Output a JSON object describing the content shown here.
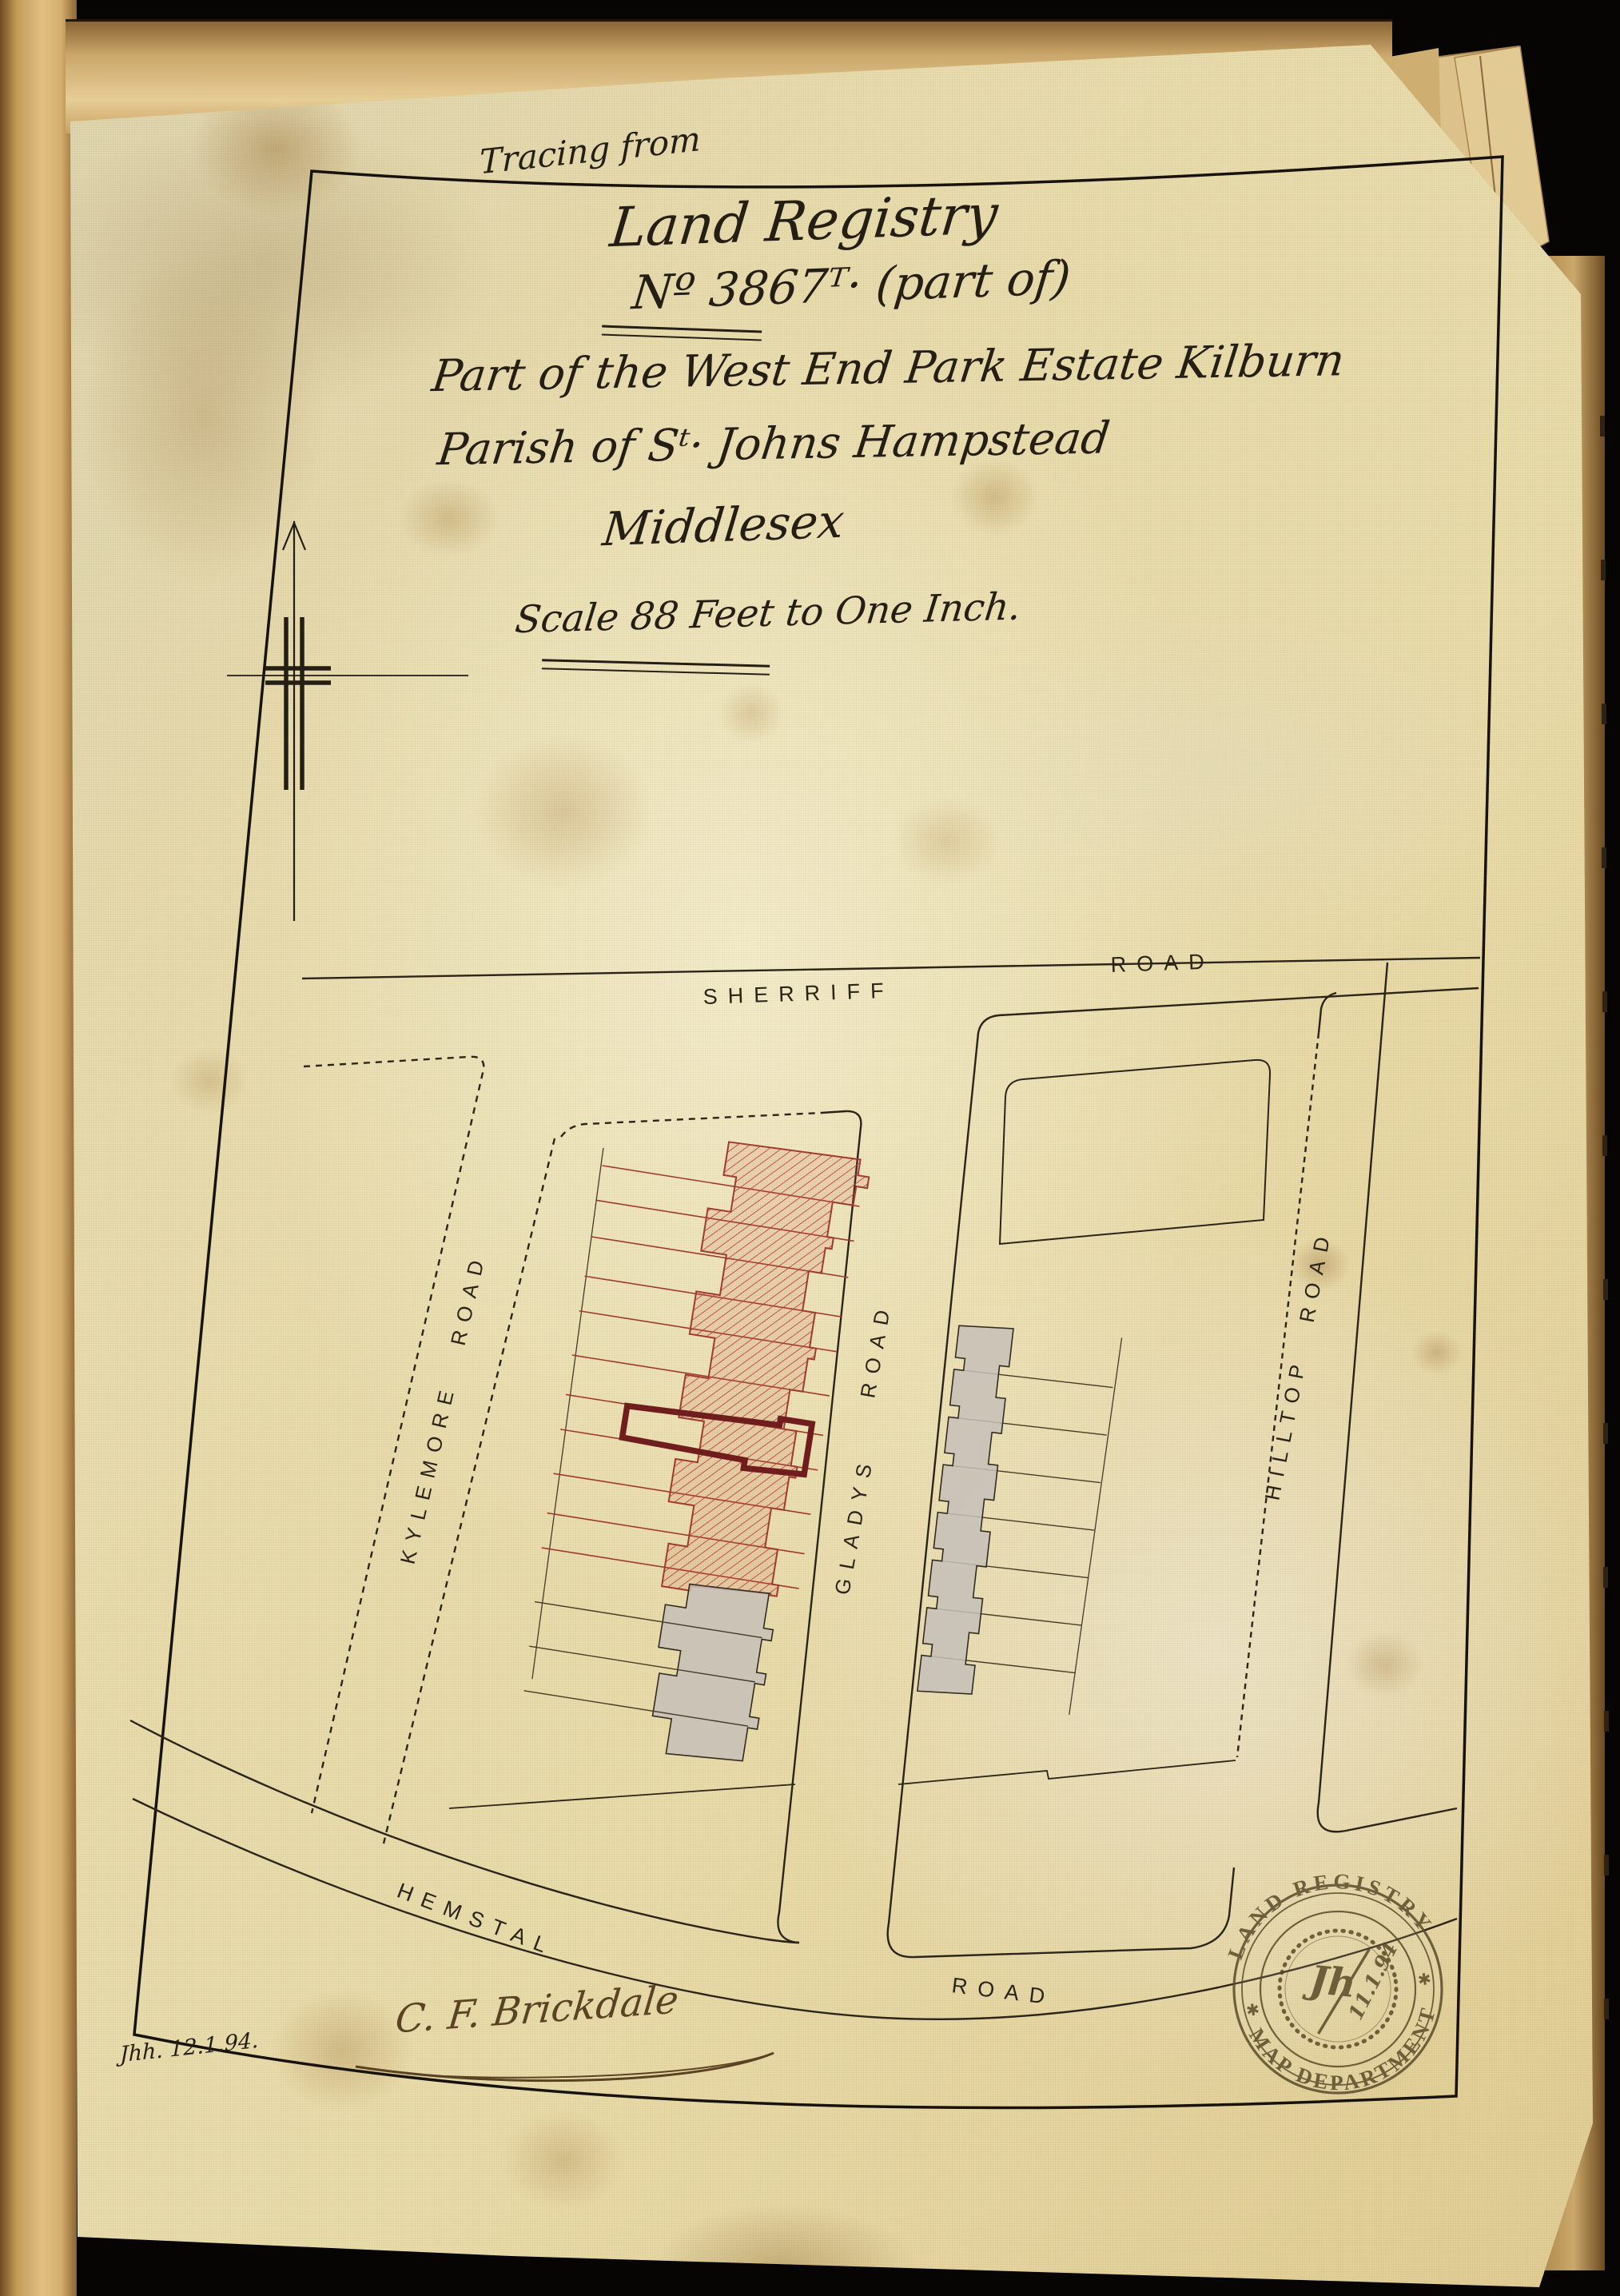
{
  "document": {
    "tracing_from": "Tracing from",
    "registry": "Land Registry",
    "number": "Nº 3867ᵀ· (part of)",
    "estate": "Part of the West End Park Estate Kilburn",
    "parish": "Parish of Sᵗ· Johns Hampstead",
    "county": "Middlesex",
    "scale": "Scale 88 Feet to One Inch.",
    "signature": "C. F. Brickdale",
    "corner_note": "Jhh. 12.1.94."
  },
  "map": {
    "roads": {
      "sherriff": {
        "word1": "SHERRIFF",
        "word2": "ROAD"
      },
      "kylemore": {
        "label": "KYLEMORE ROAD"
      },
      "gladys": {
        "word1": "GLADYS",
        "word2": "ROAD"
      },
      "hilltop": {
        "label": "HILLTOP ROAD"
      },
      "hemstal": {
        "word1": "HEMSTAL",
        "word2": "ROAD"
      }
    },
    "colors": {
      "hatch": "#b5413a",
      "highlight": "#701d1d",
      "grey_building": "#c6bfb8",
      "ink": "#2b2418"
    }
  },
  "stamp": {
    "ring_top": "LAND REGISTRY",
    "ring_bottom": "MAP DEPARTMENT",
    "monogram": "Jh",
    "date": "11.1.94",
    "star_left": "✱",
    "star_right": "✱"
  }
}
